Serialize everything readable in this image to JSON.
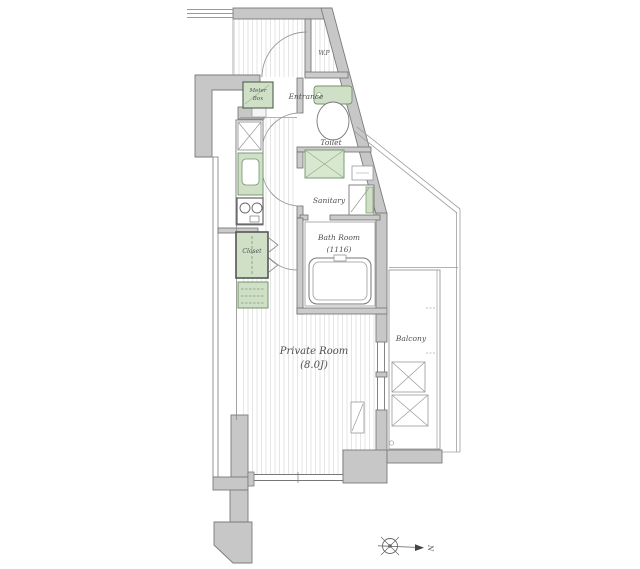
{
  "plan": {
    "labels": {
      "entrance": "Entrance",
      "wp": "W.P",
      "toilet": "Toilet",
      "sanitary": "Sanitary",
      "bath_room": "Bath Room",
      "bath_room_size": "(1116)",
      "private_room": "Private Room",
      "private_room_size": "(8.0J)",
      "balcony": "Balcony",
      "closet": "Closet",
      "meter_box_line1": "Meter",
      "meter_box_line2": "Box",
      "north": "N"
    },
    "colors": {
      "wall_fill": "#c7c7c7",
      "wall_stroke": "#7b7b7b",
      "fixture_green_fill": "#cfe0c6",
      "fixture_green_stroke": "#71936b",
      "floor_stripe": "#e5e5e5",
      "thin_line": "#8f8f8f",
      "text_color": "#4f4f4f"
    }
  }
}
